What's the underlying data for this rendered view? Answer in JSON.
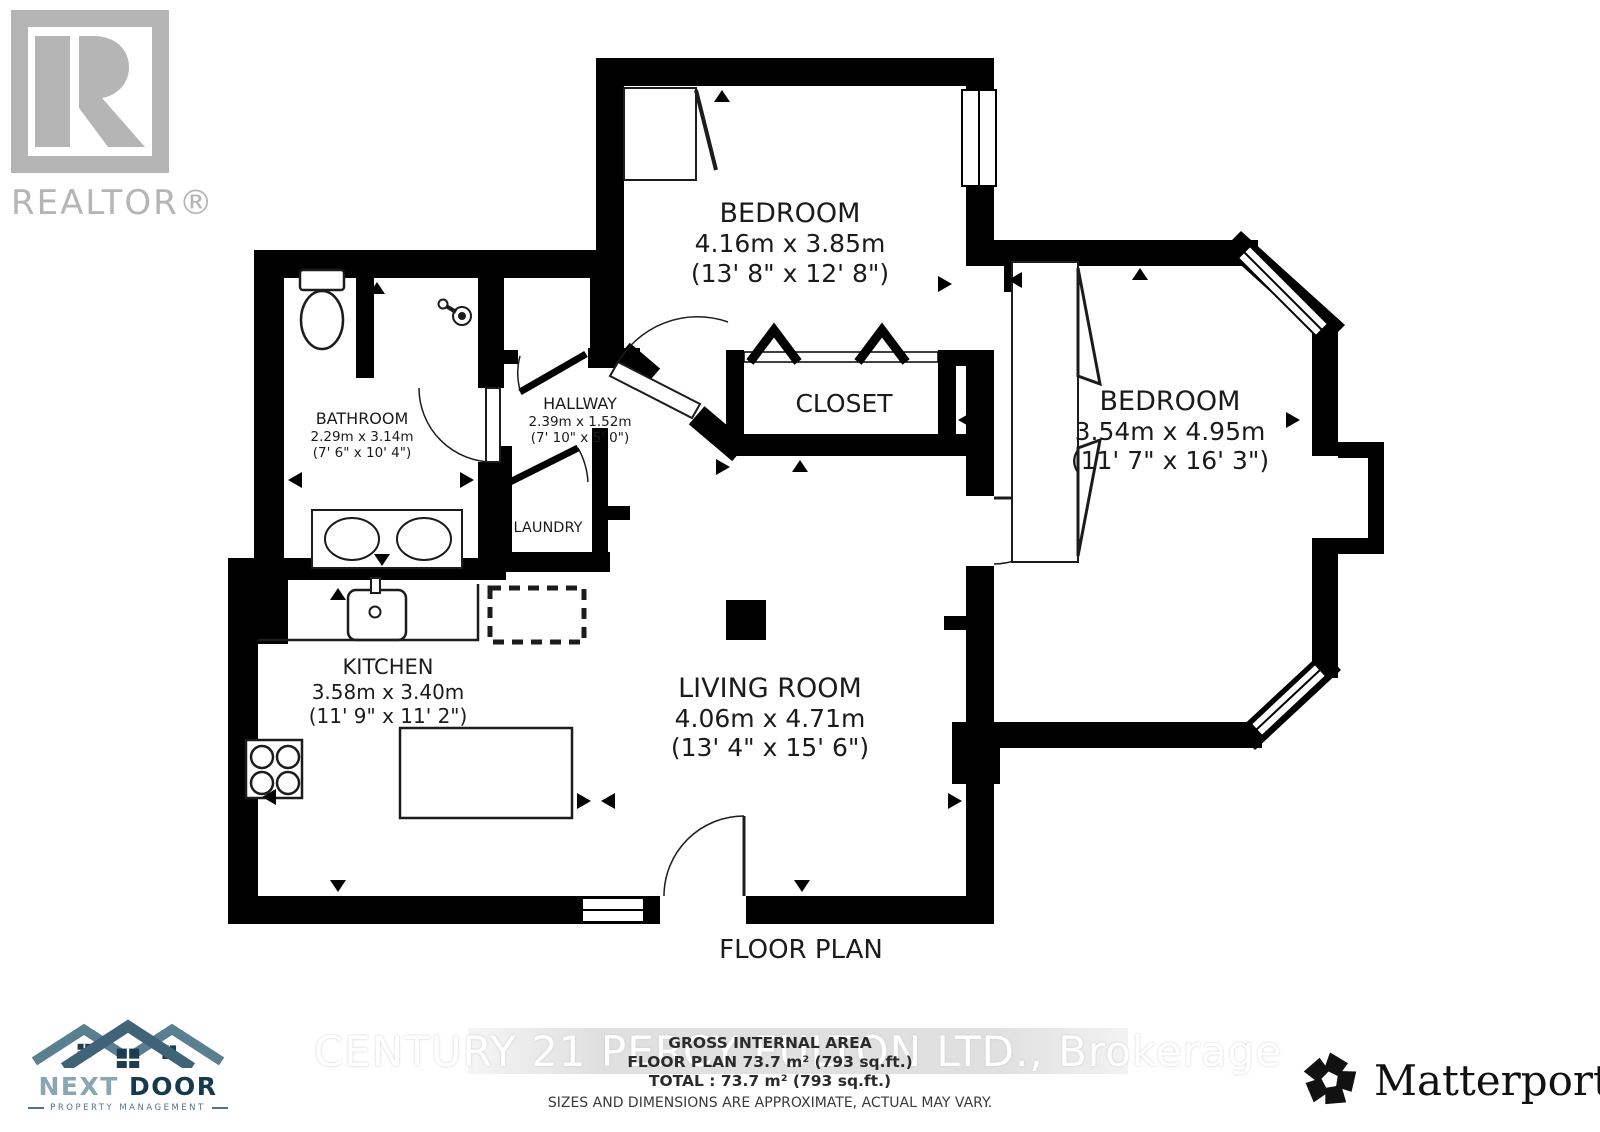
{
  "branding": {
    "realtor_logo_text": "REALTOR®",
    "watermark": "CENTURY 21 PERCY FULTON LTD., Brokerage",
    "next_door": {
      "name_light": "NEXT",
      "name_dark": "DOOR",
      "subtitle": "PROPERTY MANAGEMENT"
    },
    "matterport_name": "Matterport",
    "matterport_reg": "®"
  },
  "plan": {
    "title": "FLOOR PLAN",
    "rooms": {
      "bedroom1": {
        "name": "BEDROOM",
        "metric": "4.16m x 3.85m",
        "imperial": "(13' 8\" x 12' 8\")"
      },
      "bedroom2": {
        "name": "BEDROOM",
        "metric": "3.54m x 4.95m",
        "imperial": "(11' 7\" x 16' 3\")"
      },
      "closet": {
        "name": "CLOSET"
      },
      "hallway": {
        "name": "HALLWAY",
        "metric": "2.39m x 1.52m",
        "imperial": "(7' 10\" x 5' 0\")"
      },
      "bathroom": {
        "name": "BATHROOM",
        "metric": "2.29m x 3.14m",
        "imperial": "(7' 6\" x 10' 4\")"
      },
      "laundry": {
        "name": "LAUNDRY"
      },
      "kitchen": {
        "name": "KITCHEN",
        "metric": "3.58m x 3.40m",
        "imperial": "(11' 9\" x 11' 2\")"
      },
      "living_room": {
        "name": "LIVING ROOM",
        "metric": "4.06m x 4.71m",
        "imperial": "(13' 4\" x 15' 6\")"
      }
    }
  },
  "footer": {
    "gross_internal_area": "GROSS INTERNAL AREA",
    "floor_plan_area": "FLOOR PLAN 73.7 m² (793 sq.ft.)",
    "total_area": "TOTAL :  73.7 m² (793 sq.ft.)",
    "disclaimer": "SIZES AND DIMENSIONS ARE APPROXIMATE, ACTUAL MAY VARY."
  },
  "colors": {
    "wall": "#000000",
    "label": "#1b1b1b",
    "logo_gray": "#b5b5b5",
    "watermark_text": "#ffffff",
    "next_door_light": "#8aa6b5",
    "next_door_dark": "#16394e",
    "next_door_roof": "#5a7f91",
    "next_door_roof_center": "#3f6478",
    "matterport_black": "#111111"
  }
}
